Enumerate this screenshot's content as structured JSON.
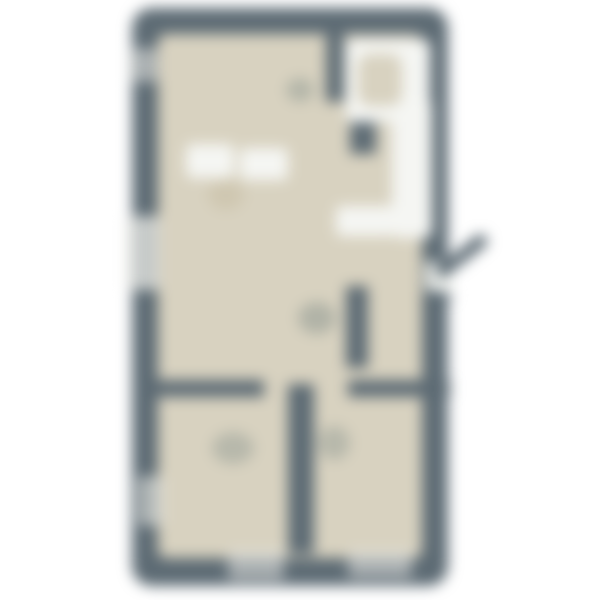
{
  "floor_plan": {
    "canvas": {
      "width": 600,
      "height": 600,
      "background": "#ffffff",
      "blur_px": 7
    },
    "colors": {
      "wall": "#5d6b74",
      "floor": "#d8d2c0",
      "fixture_white": "#f5f6f3",
      "window_light": "#e9eae5",
      "opening_white": "#eef0ec",
      "tan_blob": "#cdc4ad",
      "smudge": "#8a948e"
    },
    "shapes": [
      {
        "name": "outer-wall-shell",
        "kind": "rect",
        "x": 132,
        "y": 8,
        "w": 316,
        "h": 578,
        "r": 20,
        "color": "wall"
      },
      {
        "name": "interior-floor",
        "kind": "rect",
        "x": 158,
        "y": 34,
        "w": 264,
        "h": 524,
        "r": 8,
        "color": "floor"
      },
      {
        "name": "window-left-upper",
        "kind": "rect",
        "x": 128,
        "y": 48,
        "w": 30,
        "h": 34,
        "r": 4,
        "color": "window_light",
        "opacity": 0.55
      },
      {
        "name": "window-left-middle",
        "kind": "rect",
        "x": 126,
        "y": 216,
        "w": 34,
        "h": 74,
        "r": 4,
        "color": "window_light",
        "opacity": 0.75
      },
      {
        "name": "window-left-lower",
        "kind": "rect",
        "x": 138,
        "y": 476,
        "w": 26,
        "h": 50,
        "r": 4,
        "color": "window_light",
        "opacity": 0.6
      },
      {
        "name": "window-bottom-left",
        "kind": "rect",
        "x": 228,
        "y": 550,
        "w": 56,
        "h": 30,
        "r": 4,
        "color": "window_light",
        "opacity": 0.55
      },
      {
        "name": "window-bottom-right",
        "kind": "rect",
        "x": 348,
        "y": 550,
        "w": 64,
        "h": 28,
        "r": 4,
        "color": "window_light",
        "opacity": 0.55
      },
      {
        "name": "wall-bath-vertical-upper",
        "kind": "rect",
        "x": 326,
        "y": 28,
        "w": 18,
        "h": 74,
        "color": "wall"
      },
      {
        "name": "wall-bath-vertical-lower",
        "kind": "rect",
        "x": 350,
        "y": 92,
        "w": 26,
        "h": 62,
        "color": "wall"
      },
      {
        "name": "wall-entry-divider",
        "kind": "rect",
        "x": 346,
        "y": 286,
        "w": 22,
        "h": 82,
        "color": "wall"
      },
      {
        "name": "wall-bedroom-divider",
        "kind": "rect",
        "x": 288,
        "y": 384,
        "w": 26,
        "h": 170,
        "color": "wall"
      },
      {
        "name": "wall-bedrooms-top-left",
        "kind": "rect",
        "x": 152,
        "y": 380,
        "w": 112,
        "h": 17,
        "color": "wall"
      },
      {
        "name": "wall-bedrooms-top-right",
        "kind": "rect",
        "x": 348,
        "y": 380,
        "w": 102,
        "h": 17,
        "color": "wall"
      },
      {
        "name": "entry-door-opening",
        "kind": "rect",
        "x": 426,
        "y": 262,
        "w": 26,
        "h": 30,
        "color": "opening_white"
      },
      {
        "name": "bathroom-floor-white",
        "kind": "rect",
        "x": 346,
        "y": 40,
        "w": 84,
        "h": 82,
        "r": 6,
        "color": "fixture_white"
      },
      {
        "name": "bathtub-strip",
        "kind": "rect",
        "x": 392,
        "y": 98,
        "w": 40,
        "h": 140,
        "r": 8,
        "color": "fixture_white"
      },
      {
        "name": "vanity-band",
        "kind": "rect",
        "x": 336,
        "y": 206,
        "w": 58,
        "h": 30,
        "r": 6,
        "color": "fixture_white"
      },
      {
        "name": "kitchen-counter-left",
        "kind": "rect",
        "x": 186,
        "y": 144,
        "w": 48,
        "h": 34,
        "r": 6,
        "color": "fixture_white"
      },
      {
        "name": "kitchen-counter-right",
        "kind": "rect",
        "x": 240,
        "y": 148,
        "w": 48,
        "h": 32,
        "r": 6,
        "color": "fixture_white"
      },
      {
        "name": "bathroom-fixture-blob",
        "kind": "rect",
        "x": 358,
        "y": 54,
        "w": 44,
        "h": 52,
        "r": 12,
        "color": "floor"
      },
      {
        "name": "kitchen-table-blob",
        "kind": "blob",
        "x": 208,
        "y": 180,
        "w": 36,
        "h": 30,
        "color": "tan_blob",
        "opacity": 0.8
      },
      {
        "name": "door-smudge-bathroom",
        "kind": "blob",
        "x": 286,
        "y": 78,
        "w": 28,
        "h": 24,
        "color": "smudge",
        "opacity": 0.45
      },
      {
        "name": "door-smudge-hall",
        "kind": "blob",
        "x": 298,
        "y": 302,
        "w": 38,
        "h": 32,
        "color": "smudge",
        "opacity": 0.5
      },
      {
        "name": "door-smudge-bedroom-left",
        "kind": "blob",
        "x": 212,
        "y": 432,
        "w": 42,
        "h": 32,
        "color": "smudge",
        "opacity": 0.42
      },
      {
        "name": "door-smudge-bedroom-right",
        "kind": "blob",
        "x": 318,
        "y": 426,
        "w": 32,
        "h": 34,
        "color": "smudge",
        "opacity": 0.42
      },
      {
        "name": "entry-door-leaf",
        "kind": "rect",
        "x": 438,
        "y": 268,
        "w": 60,
        "h": 13,
        "r": 4,
        "color": "wall",
        "rotate": -38
      },
      {
        "name": "entry-door-swing",
        "kind": "tri",
        "x": 428,
        "y": 286,
        "w": 26,
        "h": 26,
        "color": "wall",
        "opacity": 0.9
      }
    ]
  }
}
